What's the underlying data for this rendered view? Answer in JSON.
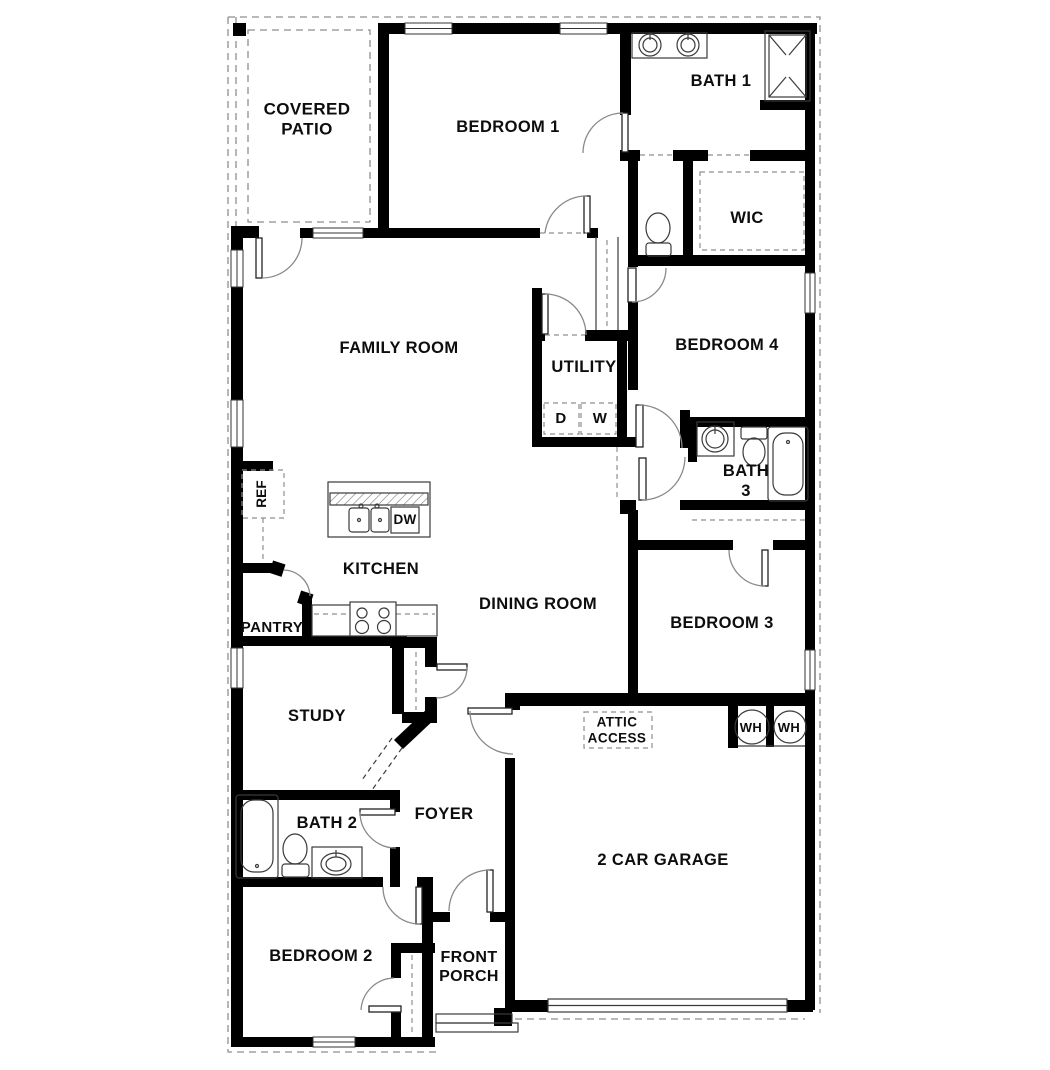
{
  "title": "Single-story house floor plan",
  "labels": {
    "covered_patio": "COVERED\nPATIO",
    "bedroom1": "BEDROOM 1",
    "bath1": "BATH 1",
    "wic": "WIC",
    "family_room": "FAMILY ROOM",
    "utility": "UTILITY",
    "dryer": "D",
    "washer": "W",
    "bedroom4": "BEDROOM 4",
    "bath3": "BATH\n3",
    "ref": "REF",
    "dw": "DW",
    "kitchen": "KITCHEN",
    "dining_room": "DINING ROOM",
    "pantry": "PANTRY",
    "bedroom3": "BEDROOM 3",
    "study": "STUDY",
    "attic_access": "ATTIC\nACCESS",
    "wh1": "WH",
    "wh2": "WH",
    "bath2": "BATH 2",
    "foyer": "FOYER",
    "garage": "2 CAR GARAGE",
    "bedroom2": "BEDROOM 2",
    "front_porch": "FRONT\nPORCH"
  },
  "colors": {
    "wall": "#000000",
    "thin_line": "#3a3a3a",
    "arc_line": "#8a8a8a",
    "dash_line": "#8f8f8f",
    "text": "#0d0d0d"
  }
}
